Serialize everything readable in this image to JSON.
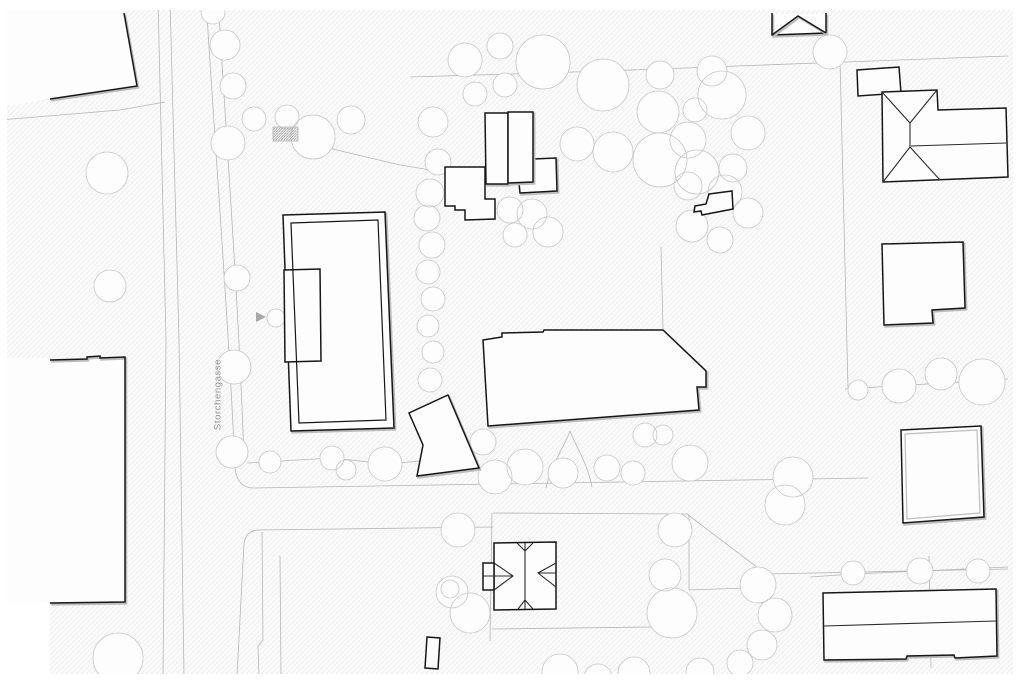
{
  "street_label": {
    "text": "Storchengasse",
    "center_x": 218,
    "center_y": 396
  },
  "colors": {
    "paper": "#ffffff",
    "ground": "#fbfbfb",
    "hatch_line": "#e9e9e9",
    "hatch_dense": "#9a9a9a",
    "parcel_line": "#b5b5b5",
    "tree_line": "#c6c6c6",
    "building_fill": "#fdfdfd",
    "building_dark": "#161616",
    "building_shadow": "#bdbdbd",
    "roof_line": "#2a2a2a",
    "label_gray": "#8f8f8f",
    "arrow_gray": "#a8a8a8"
  },
  "map": {
    "width": 1024,
    "height": 683,
    "margins": {
      "top": 10,
      "bottom": 674,
      "left": 7,
      "right": 1013,
      "wedge": [
        0,
        358,
        50,
        316
      ]
    },
    "parcel_paths": [
      "M158,0 L166,340 L163,676",
      "M170,0 L179,340 L184,676",
      "M206,0 C216,160 229,330 235,468 Q237,487 252,488 L868,478",
      "M218,0 C228,160 240,330 244,462",
      "M493,527 L258,530 Q246,531 244,543 L237,676",
      "M262,532 L263,640 L258,646 L259,676",
      "M280,556 L281,676",
      "M0,104 L50,99",
      "M0,120 L120,110 L165,102",
      "M410,77 L545,73 L660,69 L737,66 L1008,56",
      "M840,60 L848,388",
      "M845,389 L1008,379",
      "M661,247 L663,329",
      "M493,513 L687,514 L766,574 L1008,569",
      "M689,514 L689,590",
      "M689,590 L745,588",
      "M929,556 L931,668",
      "M492,513 L490,641",
      "M492,629 L652,627",
      "M247,463 L332,458 L387,464 L431,460",
      "M298,140 L345,152 L400,165 L443,172",
      "M810,577 L853,574 L920,571 L1008,567",
      "M546,488 C552,462 563,450 570,431",
      "M592,487 C587,462 577,449 570,431"
    ],
    "trees": [
      [
        107,
        173,
        21
      ],
      [
        110,
        286,
        16
      ],
      [
        213,
        12,
        12
      ],
      [
        225,
        45,
        15
      ],
      [
        233,
        86,
        13
      ],
      [
        228,
        143,
        17
      ],
      [
        254,
        119,
        12
      ],
      [
        287,
        117,
        12
      ],
      [
        313,
        137,
        22
      ],
      [
        351,
        120,
        14
      ],
      [
        237,
        278,
        13
      ],
      [
        234,
        367,
        17
      ],
      [
        232,
        452,
        16
      ],
      [
        270,
        462,
        11
      ],
      [
        276,
        318,
        9
      ],
      [
        433,
        122,
        15
      ],
      [
        438,
        162,
        13
      ],
      [
        430,
        193,
        14
      ],
      [
        427,
        218,
        13
      ],
      [
        432,
        245,
        13
      ],
      [
        428,
        272,
        12
      ],
      [
        433,
        299,
        12
      ],
      [
        428,
        326,
        11
      ],
      [
        433,
        352,
        11
      ],
      [
        430,
        380,
        12
      ],
      [
        465,
        60,
        17
      ],
      [
        500,
        46,
        13
      ],
      [
        543,
        62,
        27
      ],
      [
        475,
        94,
        12
      ],
      [
        505,
        85,
        12
      ],
      [
        603,
        85,
        26
      ],
      [
        660,
        75,
        14
      ],
      [
        658,
        112,
        21
      ],
      [
        712,
        71,
        15
      ],
      [
        695,
        110,
        12
      ],
      [
        577,
        144,
        17
      ],
      [
        613,
        152,
        20
      ],
      [
        660,
        160,
        27
      ],
      [
        688,
        140,
        18
      ],
      [
        697,
        172,
        22
      ],
      [
        722,
        95,
        24
      ],
      [
        748,
        133,
        17
      ],
      [
        733,
        168,
        14
      ],
      [
        830,
        52,
        17
      ],
      [
        688,
        186,
        14
      ],
      [
        725,
        192,
        17
      ],
      [
        748,
        213,
        15
      ],
      [
        692,
        226,
        16
      ],
      [
        720,
        240,
        13
      ],
      [
        510,
        210,
        13
      ],
      [
        532,
        214,
        15
      ],
      [
        548,
        232,
        15
      ],
      [
        515,
        235,
        12
      ],
      [
        332,
        458,
        12
      ],
      [
        346,
        470,
        10
      ],
      [
        385,
        464,
        17
      ],
      [
        483,
        442,
        13
      ],
      [
        495,
        477,
        17
      ],
      [
        525,
        467,
        18
      ],
      [
        563,
        473,
        15
      ],
      [
        607,
        468,
        13
      ],
      [
        633,
        473,
        12
      ],
      [
        645,
        435,
        12
      ],
      [
        663,
        435,
        10
      ],
      [
        690,
        463,
        18
      ],
      [
        793,
        477,
        20
      ],
      [
        458,
        530,
        17
      ],
      [
        450,
        589,
        9
      ],
      [
        452,
        592,
        16
      ],
      [
        470,
        613,
        20
      ],
      [
        675,
        530,
        17
      ],
      [
        665,
        575,
        16
      ],
      [
        672,
        613,
        25
      ],
      [
        758,
        585,
        18
      ],
      [
        775,
        615,
        17
      ],
      [
        762,
        645,
        15
      ],
      [
        785,
        505,
        20
      ],
      [
        858,
        390,
        10
      ],
      [
        899,
        386,
        17
      ],
      [
        941,
        374,
        16
      ],
      [
        982,
        382,
        23
      ],
      [
        853,
        573,
        12
      ],
      [
        920,
        571,
        13
      ],
      [
        978,
        571,
        12
      ],
      [
        118,
        658,
        25
      ],
      [
        560,
        672,
        18
      ],
      [
        598,
        678,
        14
      ],
      [
        634,
        673,
        16
      ],
      [
        700,
        672,
        14
      ],
      [
        740,
        663,
        13
      ]
    ],
    "fills_white": [
      {
        "name": "building-topleft-fill",
        "pts": [
          [
            0,
            0
          ],
          [
            124,
            0
          ],
          [
            124,
            13
          ],
          [
            137,
            86
          ],
          [
            50,
            99
          ],
          [
            0,
            107
          ]
        ]
      },
      {
        "name": "building-left-fill",
        "pts": [
          [
            0,
            361
          ],
          [
            50,
            360
          ],
          [
            125,
            357
          ],
          [
            125,
            602
          ],
          [
            50,
            603
          ],
          [
            0,
            604
          ]
        ]
      },
      {
        "name": "building-gable-top-fill",
        "pts": [
          [
            772,
            14
          ],
          [
            826,
            14
          ],
          [
            826,
            33
          ],
          [
            772,
            35
          ]
        ]
      }
    ],
    "buildings": [
      {
        "name": "building-court-outer",
        "pts": [
          [
            283,
            215
          ],
          [
            385,
            212
          ],
          [
            394,
            428
          ],
          [
            291,
            431
          ]
        ],
        "double": true
      },
      {
        "name": "building-court-annex",
        "pts": [
          [
            284,
            270
          ],
          [
            320,
            269
          ],
          [
            321,
            361
          ],
          [
            285,
            362
          ]
        ],
        "double": false
      },
      {
        "name": "building-north-stairs",
        "pts": [
          [
            445,
            167
          ],
          [
            485,
            167
          ],
          [
            485,
            199
          ],
          [
            495,
            199
          ],
          [
            495,
            219
          ],
          [
            465,
            220
          ],
          [
            465,
            210
          ],
          [
            455,
            210
          ],
          [
            455,
            206
          ],
          [
            445,
            206
          ]
        ],
        "double": false
      },
      {
        "name": "building-north-annex",
        "pts": [
          [
            533,
            159
          ],
          [
            556,
            158
          ],
          [
            557,
            191
          ],
          [
            520,
            193
          ],
          [
            519,
            183
          ],
          [
            533,
            182
          ]
        ],
        "double": true
      },
      {
        "name": "building-north-west-wing",
        "pts": [
          [
            485,
            113
          ],
          [
            508,
            113
          ],
          [
            508,
            184
          ],
          [
            486,
            184
          ]
        ],
        "double": true
      },
      {
        "name": "building-north-east-wing",
        "pts": [
          [
            508,
            112
          ],
          [
            533,
            112
          ],
          [
            533,
            182
          ],
          [
            508,
            183
          ]
        ],
        "double": true
      },
      {
        "name": "building-main-hall",
        "pts": [
          [
            483,
            340
          ],
          [
            502,
            337
          ],
          [
            502,
            333
          ],
          [
            543,
            332
          ],
          [
            544,
            330
          ],
          [
            663,
            330
          ],
          [
            706,
            371
          ],
          [
            706,
            387
          ],
          [
            697,
            387
          ],
          [
            699,
            410
          ],
          [
            488,
            426
          ]
        ],
        "double": true
      },
      {
        "name": "building-pavilion",
        "pts": [
          [
            448,
            395
          ],
          [
            479,
            468
          ],
          [
            417,
            476
          ],
          [
            423,
            445
          ],
          [
            409,
            413
          ]
        ],
        "double": true
      },
      {
        "name": "building-villa-south",
        "pts": [
          [
            494,
            543
          ],
          [
            556,
            542
          ],
          [
            556,
            609
          ],
          [
            494,
            610
          ]
        ],
        "double": false
      },
      {
        "name": "building-villa-south-porch",
        "pts": [
          [
            483,
            563
          ],
          [
            494,
            563
          ],
          [
            494,
            590
          ],
          [
            483,
            590
          ]
        ],
        "double": false
      },
      {
        "name": "building-shed-east",
        "pts": [
          [
            709,
            194
          ],
          [
            732,
            191
          ],
          [
            733,
            209
          ],
          [
            702,
            215
          ],
          [
            701,
            211
          ],
          [
            694,
            212
          ],
          [
            695,
            206
          ],
          [
            706,
            204
          ]
        ],
        "double": false
      },
      {
        "name": "building-northeast-annex",
        "pts": [
          [
            857,
            70
          ],
          [
            899,
            67
          ],
          [
            901,
            93
          ],
          [
            858,
            96
          ]
        ],
        "double": false
      },
      {
        "name": "building-northeast-hip",
        "pts": [
          [
            882,
            92
          ],
          [
            937,
            90
          ],
          [
            938,
            110
          ],
          [
            1006,
            108
          ],
          [
            1008,
            177
          ],
          [
            883,
            182
          ]
        ],
        "double": false
      },
      {
        "name": "building-east-notched",
        "pts": [
          [
            882,
            244
          ],
          [
            963,
            242
          ],
          [
            965,
            308
          ],
          [
            932,
            310
          ],
          [
            933,
            323
          ],
          [
            884,
            325
          ]
        ],
        "double": true
      },
      {
        "name": "building-east-square",
        "pts": [
          [
            901,
            430
          ],
          [
            981,
            426
          ],
          [
            984,
            517
          ],
          [
            903,
            523
          ]
        ],
        "double": true
      },
      {
        "name": "building-southeast-long",
        "pts": [
          [
            823,
            593
          ],
          [
            996,
            589
          ],
          [
            997,
            656
          ],
          [
            955,
            658
          ],
          [
            954,
            655
          ],
          [
            907,
            656
          ],
          [
            906,
            659
          ],
          [
            824,
            660
          ]
        ],
        "double": true
      },
      {
        "name": "building-south-small",
        "pts": [
          [
            427,
            637
          ],
          [
            440,
            638
          ],
          [
            438,
            669
          ],
          [
            425,
            668
          ]
        ],
        "double": false
      }
    ],
    "stroke_polylines_dark": [
      {
        "name": "building-topleft-edge",
        "pts": [
          [
            124,
            13
          ],
          [
            137,
            86
          ],
          [
            50,
            99
          ]
        ]
      },
      {
        "name": "building-left-edge",
        "pts": [
          [
            50,
            360
          ],
          [
            87,
            359
          ],
          [
            87,
            357
          ],
          [
            100,
            356
          ],
          [
            100,
            358
          ],
          [
            125,
            357
          ],
          [
            125,
            602
          ],
          [
            50,
            603
          ]
        ]
      },
      {
        "name": "building-gable-top-walls",
        "pts": [
          [
            772,
            13
          ],
          [
            772,
            35
          ],
          [
            826,
            33
          ],
          [
            826,
            13
          ]
        ]
      },
      {
        "name": "building-gable-top-roof",
        "pts": [
          [
            772,
            35
          ],
          [
            798,
            16
          ],
          [
            826,
            33
          ]
        ]
      }
    ],
    "inner_gray_polygons": [
      {
        "name": "building-east-square-inner",
        "pts": [
          [
            905,
            434
          ],
          [
            977,
            430
          ],
          [
            980,
            513
          ],
          [
            907,
            519
          ]
        ]
      }
    ],
    "inner_dark_polygons": [
      {
        "name": "building-court-inner",
        "pts": [
          [
            291,
            223
          ],
          [
            378,
            220
          ],
          [
            386,
            420
          ],
          [
            299,
            423
          ]
        ]
      }
    ],
    "roof_lines": [
      [
        [
          525,
          543
        ],
        [
          525,
          609
        ]
      ],
      [
        [
          517,
          543
        ],
        [
          525,
          551
        ],
        [
          533,
          543
        ]
      ],
      [
        [
          518,
          609
        ],
        [
          525,
          600
        ],
        [
          533,
          609
        ]
      ],
      [
        [
          494,
          563
        ],
        [
          513,
          576
        ],
        [
          494,
          590
        ]
      ],
      [
        [
          483,
          576
        ],
        [
          513,
          576
        ]
      ],
      [
        [
          556,
          563
        ],
        [
          538,
          573
        ],
        [
          556,
          587
        ]
      ],
      [
        [
          538,
          573
        ],
        [
          556,
          573
        ]
      ],
      [
        [
          882,
          92
        ],
        [
          910,
          123
        ]
      ],
      [
        [
          937,
          90
        ],
        [
          910,
          123
        ]
      ],
      [
        [
          910,
          123
        ],
        [
          910,
          147
        ]
      ],
      [
        [
          910,
          147
        ],
        [
          883,
          182
        ]
      ],
      [
        [
          910,
          147
        ],
        [
          940,
          180
        ]
      ],
      [
        [
          911,
          146
        ],
        [
          1006,
          143
        ]
      ],
      [
        [
          824,
          626
        ],
        [
          996,
          621
        ]
      ]
    ],
    "detail_rect": {
      "name": "crosswalk-hatch",
      "x": 273,
      "y": 127,
      "w": 25,
      "h": 14
    },
    "arrow": {
      "name": "entrance-arrow",
      "pts": [
        [
          256,
          312
        ],
        [
          266,
          317
        ],
        [
          256,
          322
        ]
      ]
    }
  }
}
